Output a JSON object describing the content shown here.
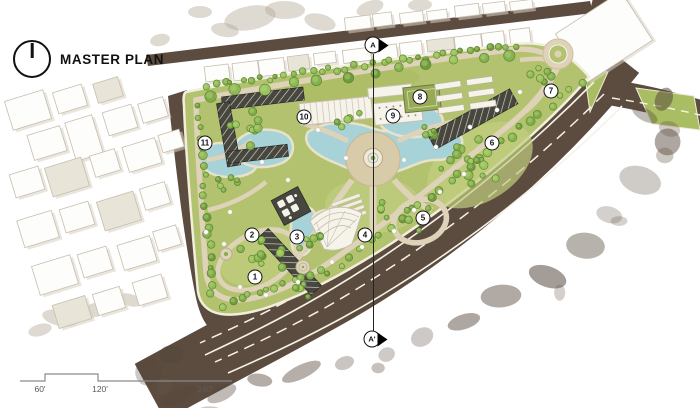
{
  "title": {
    "label": "MASTER PLAN"
  },
  "icons": {
    "north_arrow": "north-arrow-icon",
    "section_flag": "section-flag-icon"
  },
  "section_markers": [
    {
      "label": "A",
      "x": 373,
      "y": 45
    },
    {
      "label": "A'",
      "x": 372,
      "y": 339
    }
  ],
  "callouts": [
    {
      "n": "1",
      "x": 255,
      "y": 277
    },
    {
      "n": "2",
      "x": 252,
      "y": 235
    },
    {
      "n": "3",
      "x": 297,
      "y": 237
    },
    {
      "n": "4",
      "x": 365,
      "y": 235
    },
    {
      "n": "5",
      "x": 423,
      "y": 218
    },
    {
      "n": "6",
      "x": 492,
      "y": 143
    },
    {
      "n": "7",
      "x": 551,
      "y": 91
    },
    {
      "n": "8",
      "x": 420,
      "y": 97
    },
    {
      "n": "9",
      "x": 393,
      "y": 116
    },
    {
      "n": "10",
      "x": 304,
      "y": 117
    },
    {
      "n": "11",
      "x": 205,
      "y": 143
    }
  ],
  "scale_bar": {
    "labels": [
      {
        "text": "60'",
        "x": 40,
        "y": 384
      },
      {
        "text": "120'",
        "x": 100,
        "y": 384
      },
      {
        "text": "240'",
        "x": 205,
        "y": 384
      }
    ]
  },
  "palette": {
    "park-green": "#b3c26e",
    "lawn-light": "#c6d189",
    "water-blue": "#a6d2d8",
    "path-tan": "#ded3b8",
    "plaza-tan": "#d8cba9",
    "road-brown": "#5c4c3f",
    "trellis-dark": "#474740",
    "ink": "#111111",
    "scale-gray": "#5a5a5a"
  }
}
